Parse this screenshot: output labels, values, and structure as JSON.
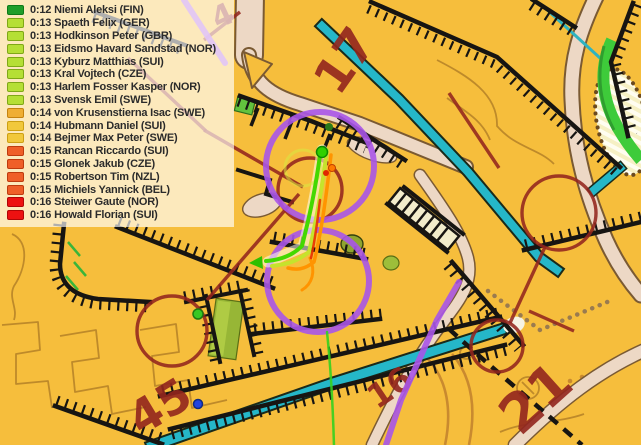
{
  "leaderboard": {
    "rows": [
      {
        "time": "0:12",
        "name": "Niemi Aleksi",
        "nation": "FIN",
        "swatch": {
          "fill": "#1F9E2A",
          "border": "#0E7A18"
        }
      },
      {
        "time": "0:13",
        "name": "Spaeth Felix",
        "nation": "GER",
        "swatch": {
          "fill": "#B5DF35",
          "border": "#7FA816"
        }
      },
      {
        "time": "0:13",
        "name": "Hodkinson Peter",
        "nation": "GBR",
        "swatch": {
          "fill": "#B5DF35",
          "border": "#7FA816"
        }
      },
      {
        "time": "0:13",
        "name": "Eidsmo Havard Sandstad",
        "nation": "NOR",
        "swatch": {
          "fill": "#B5DF35",
          "border": "#7FA816"
        }
      },
      {
        "time": "0:13",
        "name": "Kyburz Matthias",
        "nation": "SUI",
        "swatch": {
          "fill": "#B5DF35",
          "border": "#7FA816"
        }
      },
      {
        "time": "0:13",
        "name": "Kral Vojtech",
        "nation": "CZE",
        "swatch": {
          "fill": "#B5DF35",
          "border": "#7FA816"
        }
      },
      {
        "time": "0:13",
        "name": "Harlem Fosser Kasper",
        "nation": "NOR",
        "swatch": {
          "fill": "#B5DF35",
          "border": "#7FA816"
        }
      },
      {
        "time": "0:13",
        "name": "Svensk Emil",
        "nation": "SWE",
        "swatch": {
          "fill": "#B5DF35",
          "border": "#7FA816"
        }
      },
      {
        "time": "0:14",
        "name": "von Krusenstierna Isac",
        "nation": "SWE",
        "swatch": {
          "fill": "#EFAE33",
          "border": "#C5830F"
        }
      },
      {
        "time": "0:14",
        "name": "Hubmann Daniel",
        "nation": "SUI",
        "swatch": {
          "fill": "#F1C83B",
          "border": "#CDA013"
        }
      },
      {
        "time": "0:14",
        "name": "Bejmer Max Peter",
        "nation": "SWE",
        "swatch": {
          "fill": "#F1C83B",
          "border": "#CDA013"
        }
      },
      {
        "time": "0:15",
        "name": "Rancan Riccardo",
        "nation": "SUI",
        "swatch": {
          "fill": "#EF5F28",
          "border": "#BE3B0E"
        }
      },
      {
        "time": "0:15",
        "name": "Glonek Jakub",
        "nation": "CZE",
        "swatch": {
          "fill": "#EF5F28",
          "border": "#BE3B0E"
        }
      },
      {
        "time": "0:15",
        "name": "Robertson Tim",
        "nation": "NZL",
        "swatch": {
          "fill": "#EF5F28",
          "border": "#BE3B0E"
        }
      },
      {
        "time": "0:15",
        "name": "Michiels Yannick",
        "nation": "BEL",
        "swatch": {
          "fill": "#EF5F28",
          "border": "#BE3B0E"
        }
      },
      {
        "time": "0:16",
        "name": "Steiwer Gaute",
        "nation": "NOR",
        "swatch": {
          "fill": "#ED1111",
          "border": "#AF0606"
        }
      },
      {
        "time": "0:16",
        "name": "Howald Florian",
        "nation": "SUI",
        "swatch": {
          "fill": "#ED1111",
          "border": "#AF0606"
        }
      }
    ]
  },
  "map": {
    "labels": [
      {
        "text": "17"
      },
      {
        "text": "45"
      },
      {
        "text": "16"
      },
      {
        "text": "21"
      },
      {
        "text": "4"
      }
    ],
    "colors": {
      "open_yellow": "#F6BE3C",
      "road_tan": "#E9D6C3",
      "water_cyan": "#2CB9C4",
      "wall_black": "#171512",
      "number_dark_red": "#93261E",
      "course_purple": "#A855E8",
      "track_green": "#44D800",
      "track_yellow_green": "#C6E32C",
      "track_orange": "#FF9400",
      "track_red": "#E83000",
      "gps_dot_blue": "#2244E0"
    }
  }
}
